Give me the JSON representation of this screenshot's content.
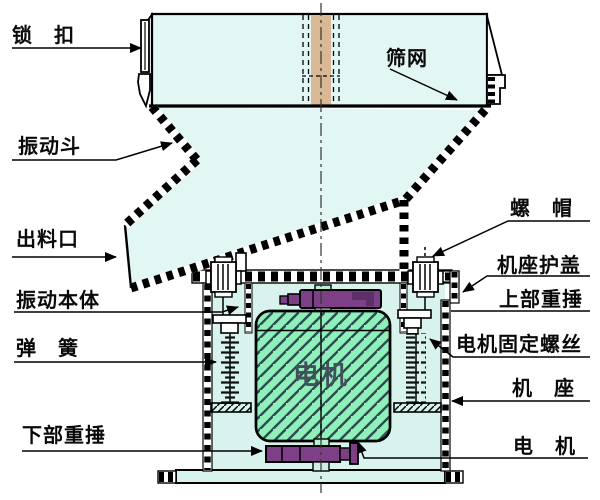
{
  "diagram": {
    "type": "technical-diagram",
    "subject": "vibrating sieve machine cross-section",
    "labels": {
      "lock": "锁　扣",
      "sieve_mesh": "筛网",
      "vibrating_hopper": "振动斗",
      "discharge_outlet": "出料口",
      "vibrating_body": "振动本体",
      "spring": "弹　簧",
      "lower_weight": "下部重捶",
      "nut": "螺　帽",
      "base_cover": "机座护盖",
      "upper_weight": "上部重捶",
      "motor_fixing_screw": "电机固定螺丝",
      "machine_base": "机　座",
      "motor": "电　机",
      "motor_body_text": "电机"
    },
    "colors": {
      "container_fill": "#e2f6f4",
      "base_fill": "#d8f2ee",
      "motor_fill": "#90f0ba",
      "weight_fill": "#7d4086",
      "weight_dark": "#5e2f68",
      "shaft_fill": "#d9b896",
      "pale_green": "#b9f0cf",
      "pale_cyan": "#cdeee6",
      "outline": "#000000"
    }
  }
}
